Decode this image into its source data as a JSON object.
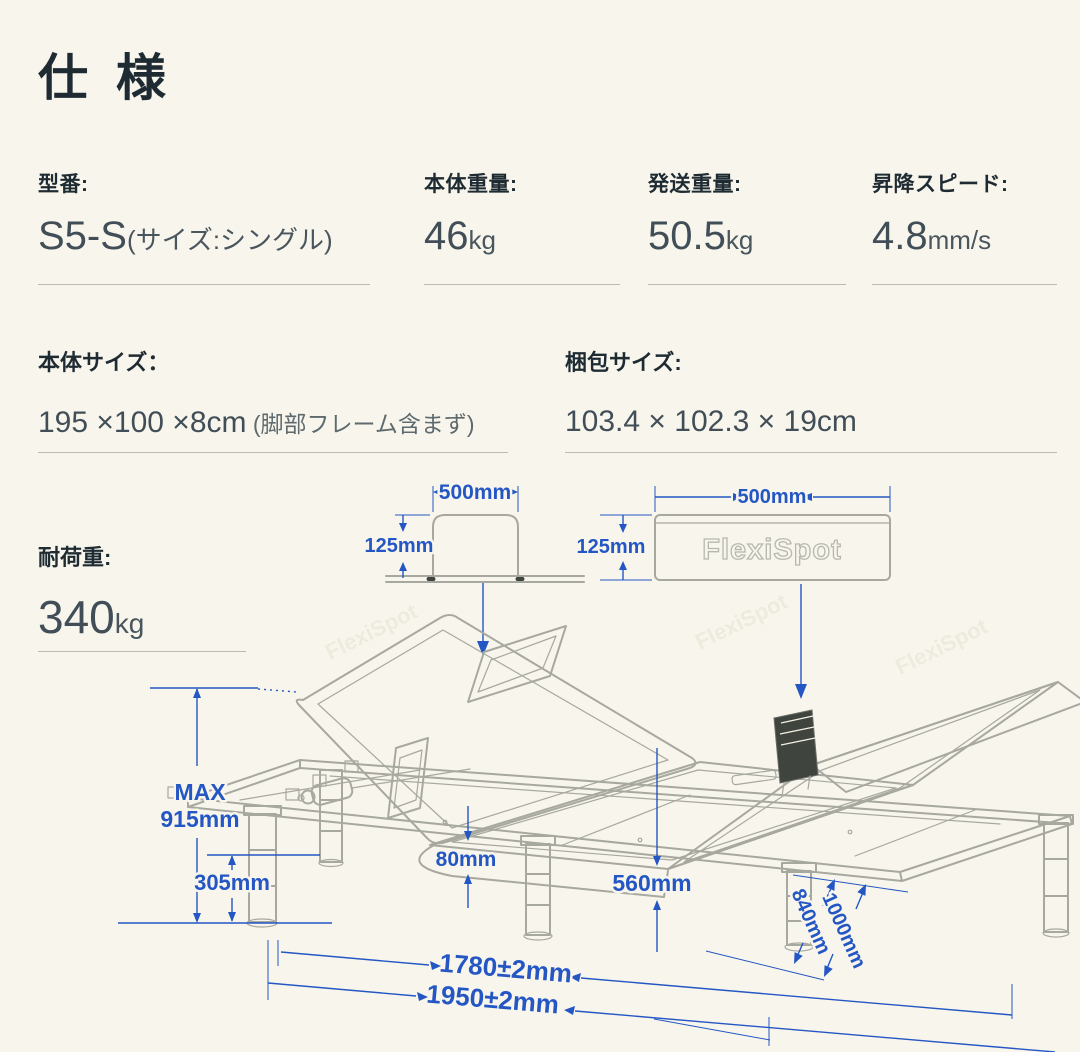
{
  "page": {
    "title": "仕 様"
  },
  "colors": {
    "background": "#f8f6ec",
    "ink": "#1f2b33",
    "value_text": "#414e57",
    "dimension_blue": "#2456c4",
    "line_art_gray": "#a7a89f",
    "rule_gray": "#b9bcb1"
  },
  "specs_row1": [
    {
      "label": "型番:",
      "value_main": "S5-S",
      "value_sub": "(サイズ:シングル)"
    },
    {
      "label": "本体重量:",
      "value_main": "46",
      "value_sub": "kg"
    },
    {
      "label": "発送重量:",
      "value_main": "50.5",
      "value_sub": "kg"
    },
    {
      "label": "昇降スピード:",
      "value_main": "4.8",
      "value_sub": "mm/s"
    }
  ],
  "specs_row2": [
    {
      "label": "本体サイズ：",
      "value_main": "195 ×100 ×8cm",
      "value_sub": " (脚部フレーム含まず)"
    },
    {
      "label": "梱包サイズ:",
      "value_main": "103.4 × 102.3 × 19cm",
      "value_sub": ""
    }
  ],
  "load": {
    "label": "耐荷重:",
    "value_main": "340",
    "value_sub": "kg"
  },
  "diagram": {
    "bracket": {
      "width_label": "500mm",
      "height_label": "125mm"
    },
    "package_box": {
      "width_label": "500mm",
      "height_label": "125mm",
      "brand": "FlexiSpot"
    },
    "bed": {
      "max_height_label_1": "MAX",
      "max_height_label_2": "915mm",
      "leg_height_label": "305mm",
      "frame_thickness_label": "80mm",
      "under_clearance_label": "560mm",
      "inner_length_label": "1780±2mm",
      "outer_length_label": "1950±2mm",
      "inner_width_label": "840mm",
      "outer_width_label": "1000mm"
    }
  }
}
